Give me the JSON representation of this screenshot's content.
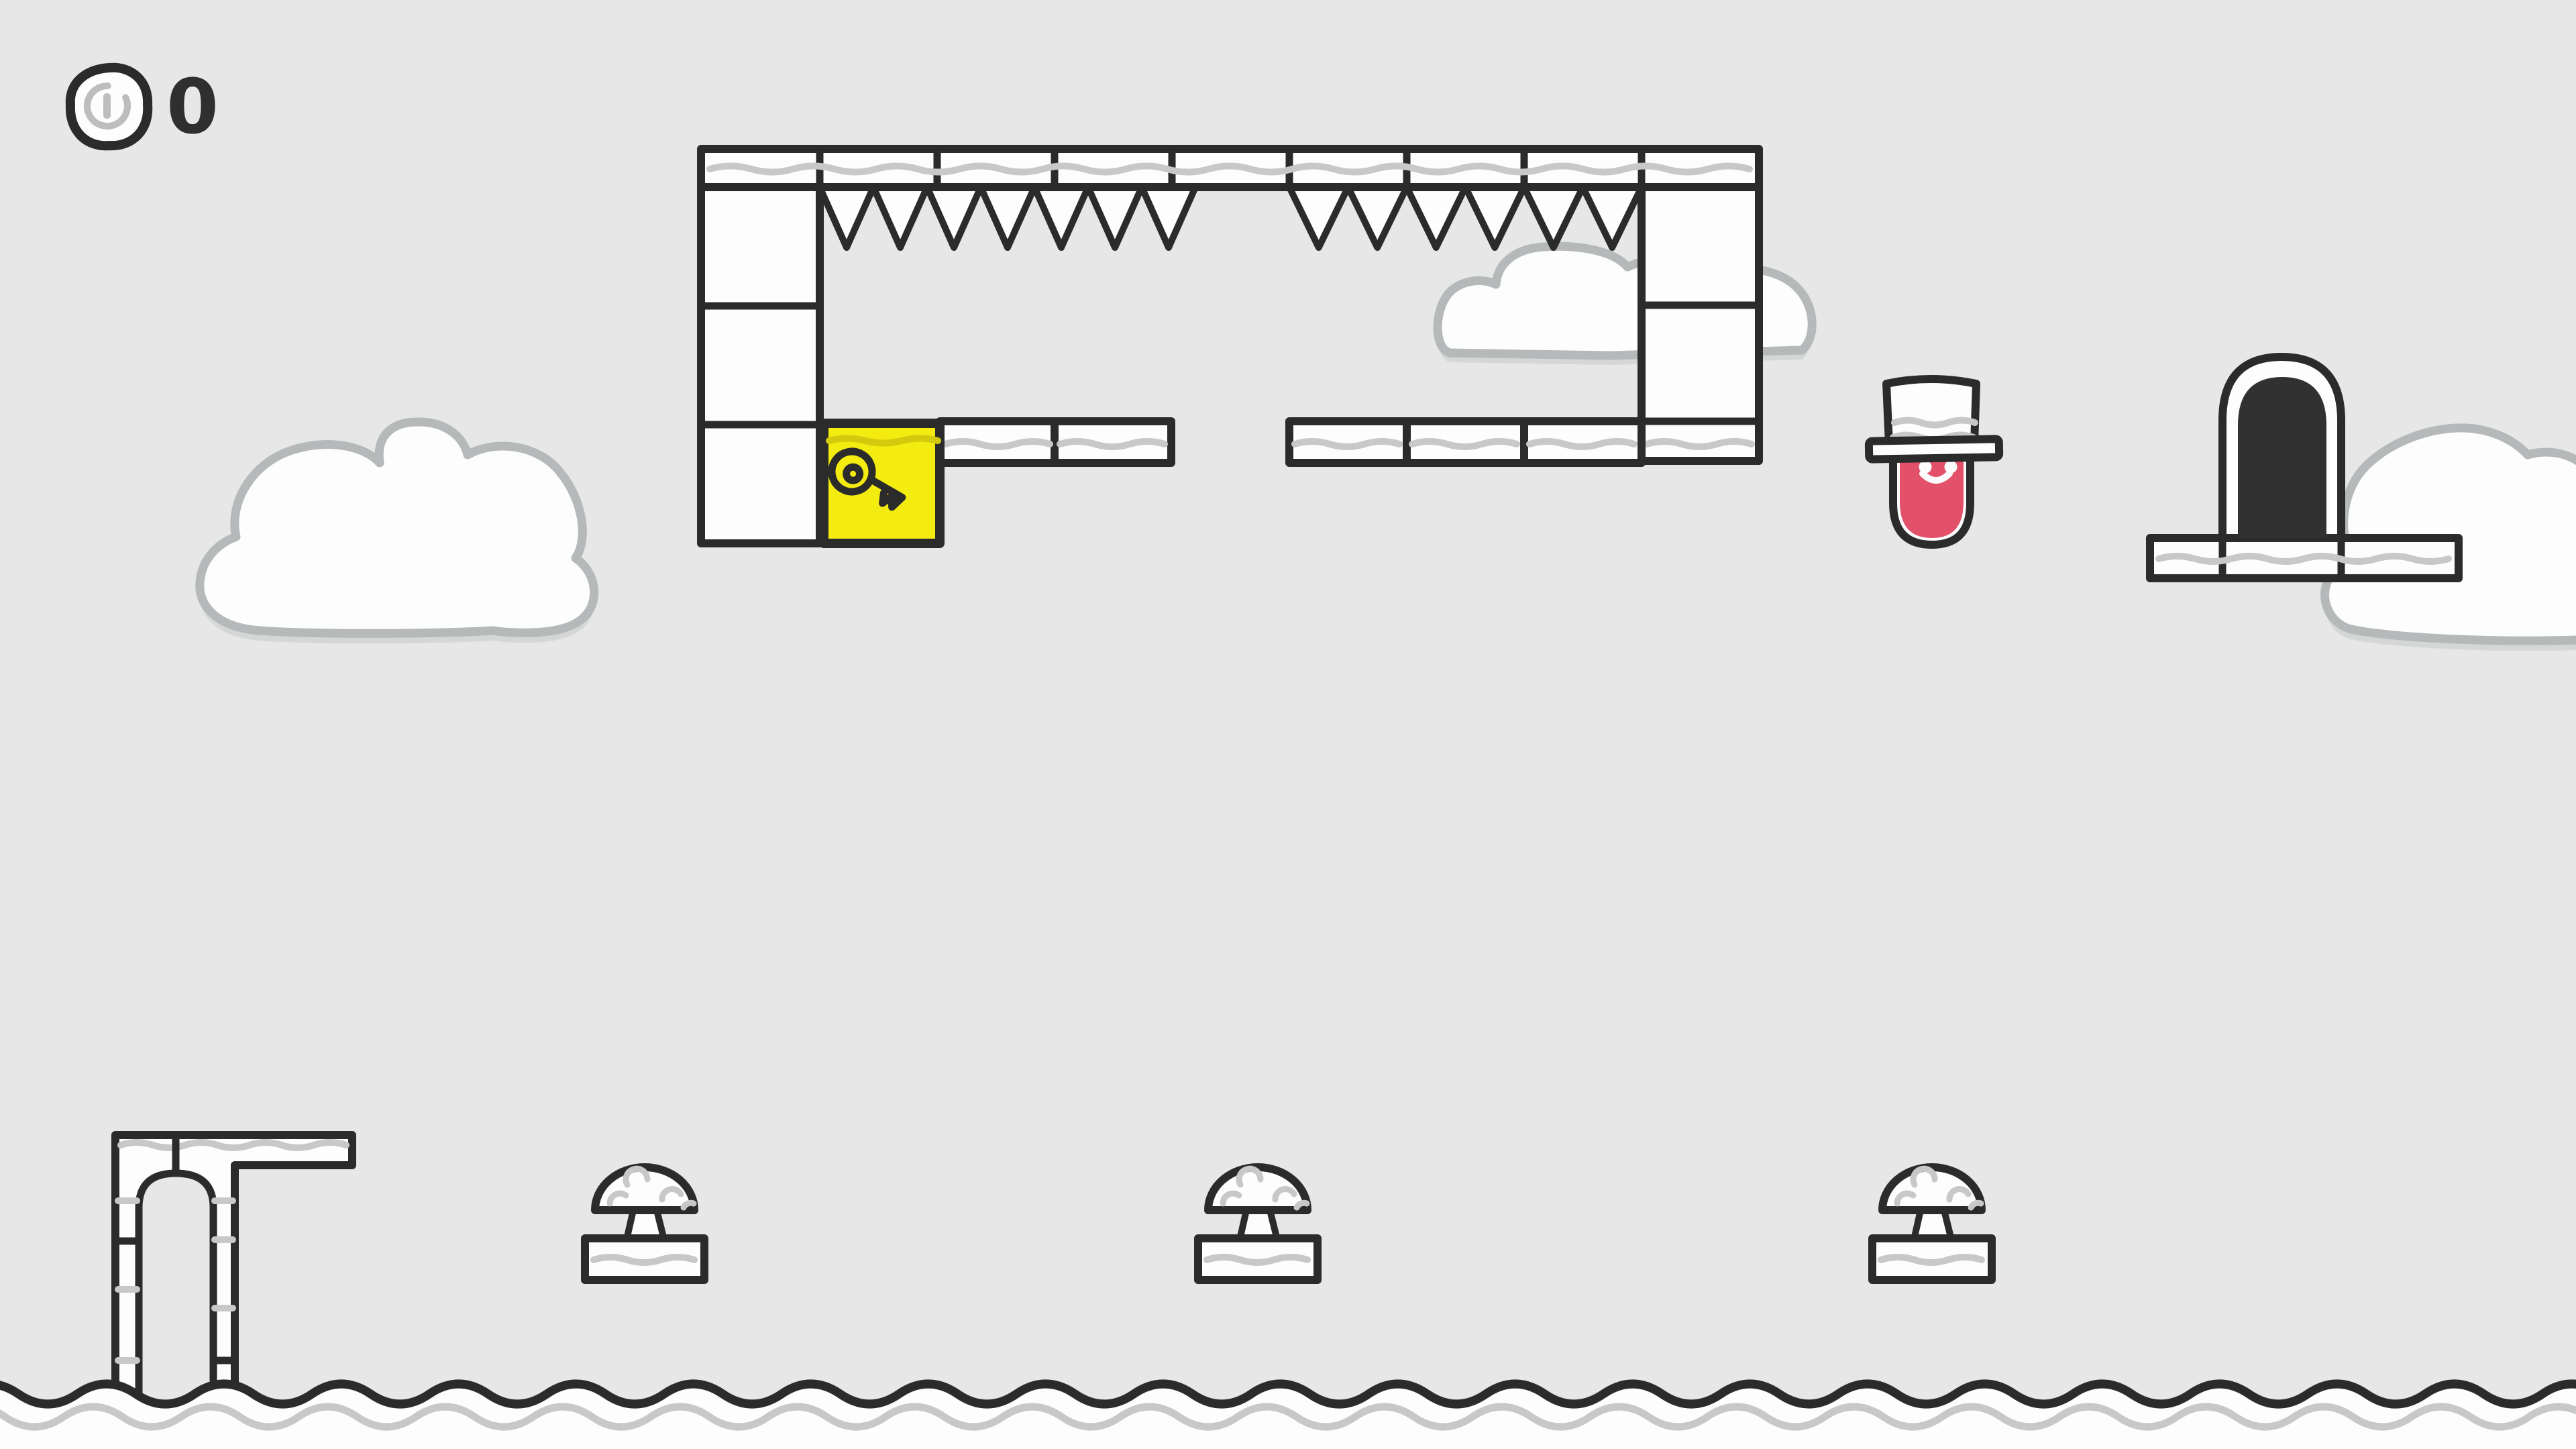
{
  "hud": {
    "coin_count": "0",
    "coin_icon": "coin-icon"
  },
  "colors": {
    "background": "#e7e7e7",
    "ink": "#2b2b2b",
    "white": "#fdfdfd",
    "seam_gray": "#c8c8c8",
    "cloud_outline": "#b5b9b9",
    "cloud_shadow": "#d5d7d7",
    "key_yellow": "#f4eb11",
    "key_shade": "#d3c90d",
    "player_pink": "#e25069",
    "door_dark": "#313131",
    "counter_text": "#2f2f2f",
    "coin_detail_gray": "#bdbdbd"
  },
  "scene": {
    "player": {
      "body": "pink blob",
      "hat": "white top hat",
      "expression": "smiling"
    },
    "key_block": {
      "icon": "key-icon",
      "fill": "yellow"
    },
    "exit_door": {
      "style": "dark arched doorway"
    },
    "spikes": {
      "left_group_count": 7,
      "right_group_count": 6
    },
    "mushroom_platform_count": 3,
    "cloud_count": 3
  }
}
